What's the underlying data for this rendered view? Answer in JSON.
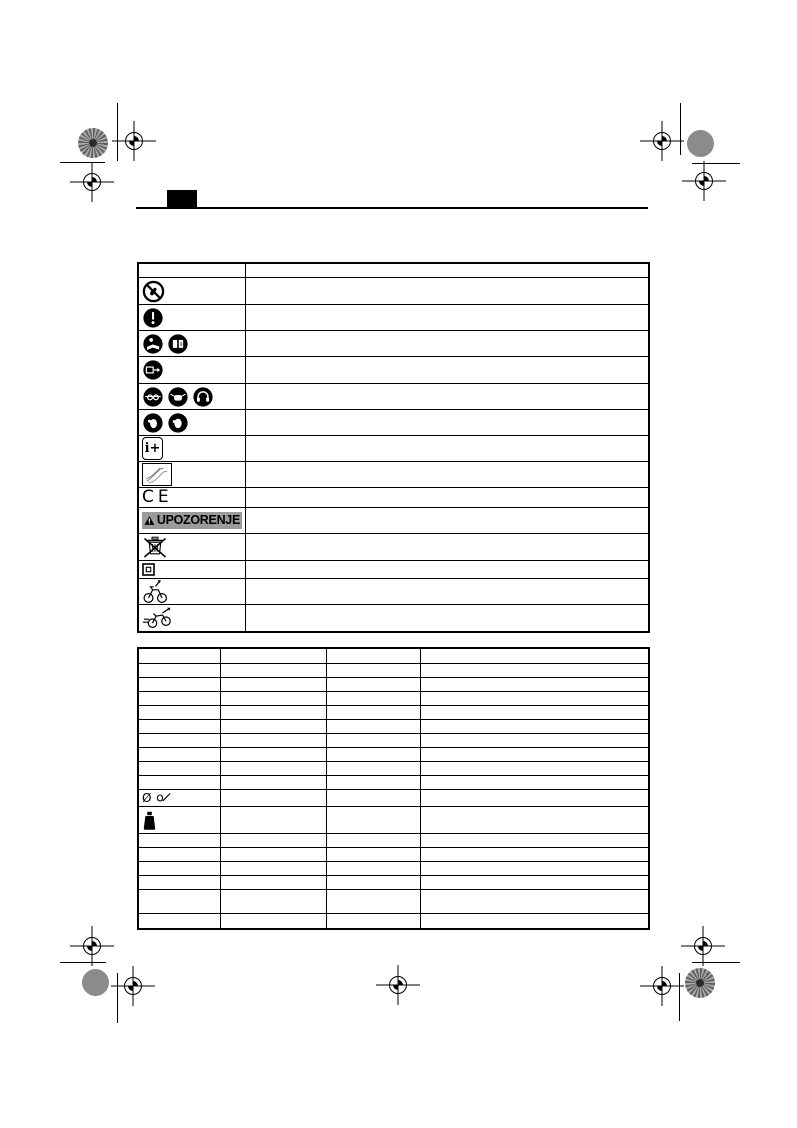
{
  "page": {
    "kind": "printed-manual-symbols-page",
    "background": "#ffffff",
    "ink_color": "#000000"
  },
  "header": {
    "index_tab": "black-index-tab",
    "rule": "horizontal-rule"
  },
  "print_marks": {
    "registration_gray": "#8b8b8b",
    "top_left": [
      "color-segment-wheel",
      "registration-crosshair",
      "registration-crosshair",
      "crop-line-vertical",
      "crop-line-horizontal"
    ],
    "top_right": [
      "registration-crosshair",
      "gray-dot",
      "registration-crosshair",
      "crop-line-vertical",
      "crop-line-horizontal"
    ],
    "bottom_left": [
      "registration-crosshair",
      "gray-dot",
      "registration-crosshair",
      "crop-line-vertical",
      "crop-line-horizontal"
    ],
    "bottom_center": [
      "registration-crosshair"
    ],
    "bottom_right": [
      "registration-crosshair",
      "color-segment-wheel",
      "registration-crosshair",
      "crop-line-vertical",
      "crop-line-horizontal"
    ]
  },
  "symbols_table": {
    "columns": [
      "symbol",
      "description"
    ],
    "rows": [
      {
        "icons": []
      },
      {
        "icons": [
          "do-not-touch-prohibition-icon"
        ]
      },
      {
        "icons": [
          "mandatory-attention-icon"
        ]
      },
      {
        "icons": [
          "read-user-manual-icon",
          "open-manual-book-icon"
        ]
      },
      {
        "icons": [
          "remove-battery-icon"
        ]
      },
      {
        "icons": [
          "wear-eye-protection-icon",
          "wear-dust-mask-icon",
          "wear-ear-protection-icon"
        ]
      },
      {
        "icons": [
          "wear-glove-icon",
          "wear-glove-icon"
        ]
      },
      {
        "icons": [
          "additional-information-icon"
        ],
        "label": "i+"
      },
      {
        "icons": [
          "hand-sketch-icon"
        ]
      },
      {
        "icons": [
          "ce-mark"
        ],
        "label": "CE"
      },
      {
        "icons": [
          "warning-triangle-icon"
        ],
        "label": "UPOZORENJE"
      },
      {
        "icons": [
          "weee-crossed-bin-icon"
        ]
      },
      {
        "icons": [
          "protection-class-ii-icon"
        ]
      },
      {
        "icons": [
          "bicycle-arrow-icon"
        ]
      },
      {
        "icons": [
          "speeding-bicycle-icon"
        ]
      }
    ]
  },
  "warning_banner": {
    "text": "UPOZORENJE",
    "background": "#9b9b9b"
  },
  "spec_table": {
    "column_count": 4,
    "row_count": 18,
    "cells_empty": true,
    "symbol_rows": {
      "diameter": {
        "label": "Ø",
        "icons": [
          "blade-diameter-icon"
        ]
      },
      "weight": {
        "icons": [
          "weight-icon"
        ]
      }
    }
  }
}
